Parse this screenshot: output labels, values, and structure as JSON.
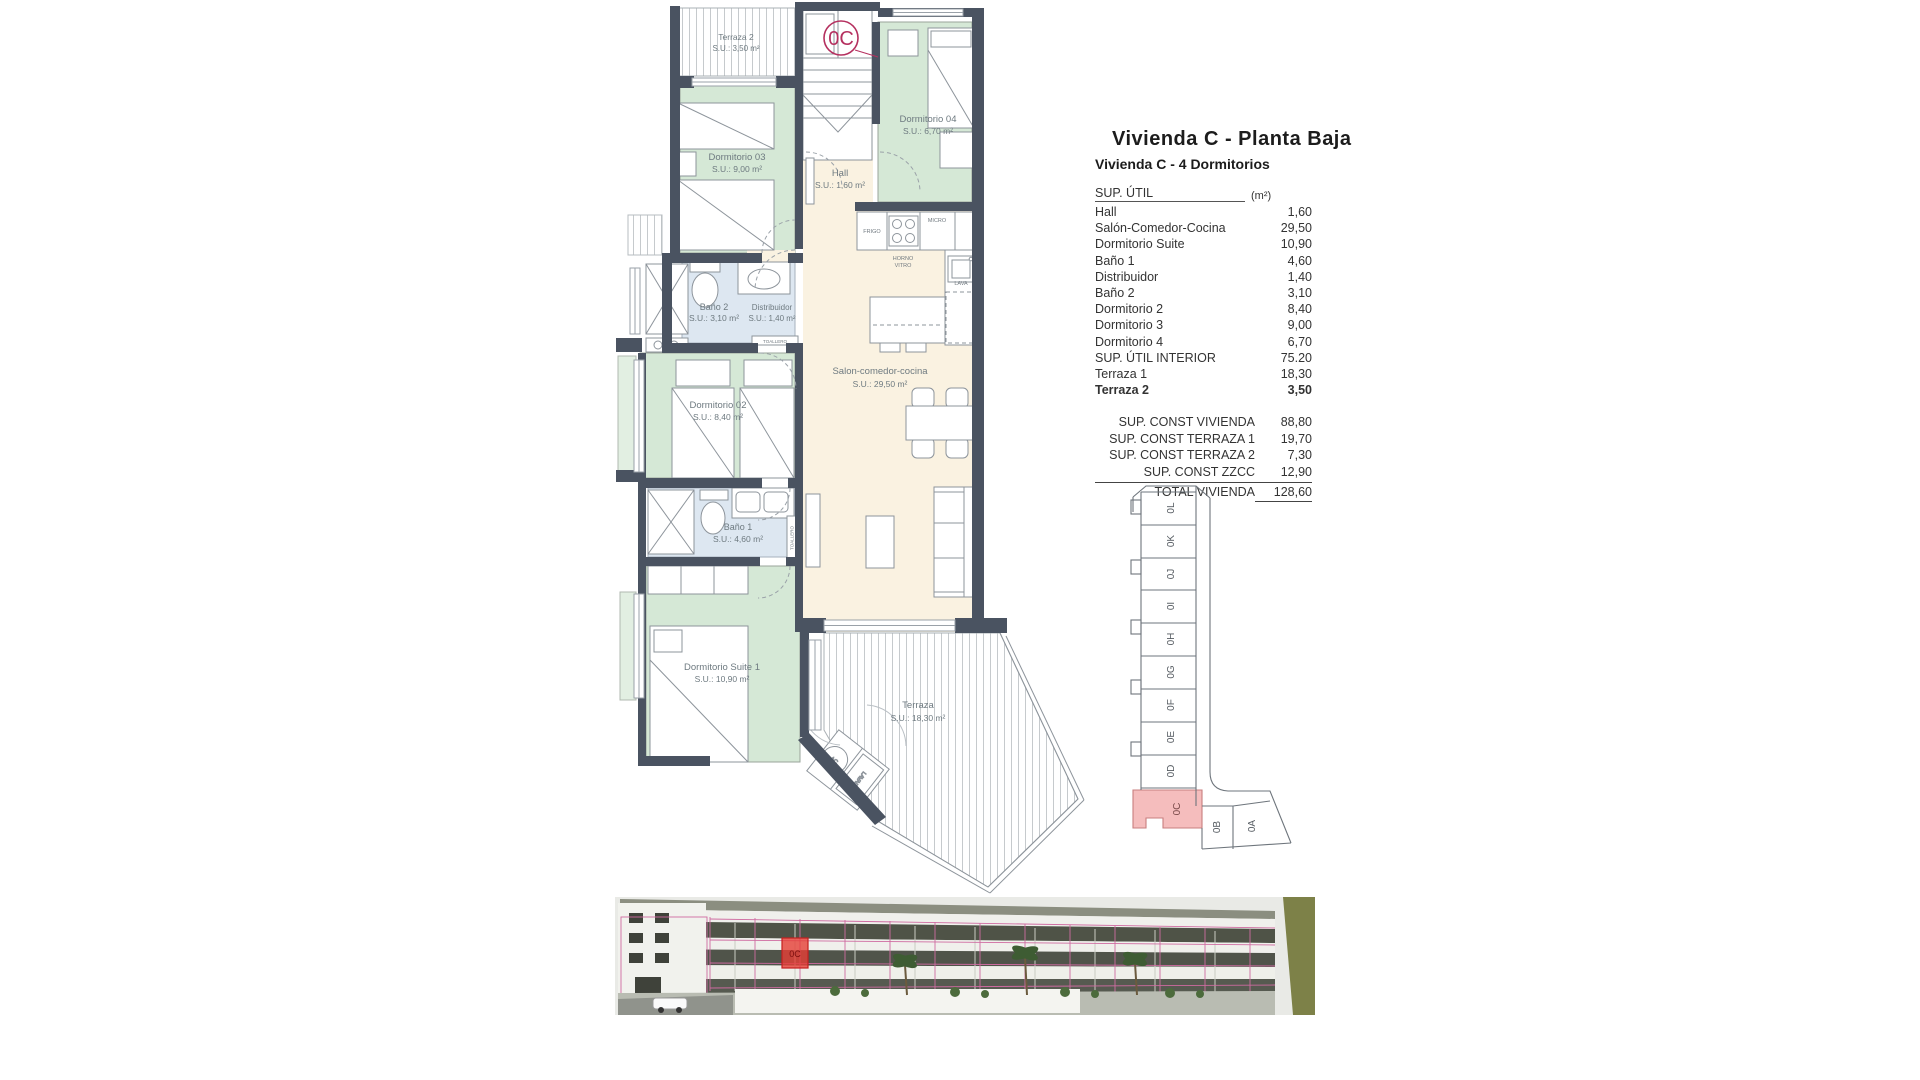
{
  "panel": {
    "title": "Vivienda C - Planta Baja",
    "subtitle": "Vivienda C - 4 Dormitorios",
    "header": {
      "label": "SUP. ÚTIL",
      "unit": "(m²)"
    },
    "rows": [
      {
        "label": "Hall",
        "value": "1,60"
      },
      {
        "label": "Salón-Comedor-Cocina",
        "value": "29,50"
      },
      {
        "label": "Dormitorio Suite",
        "value": "10,90"
      },
      {
        "label": "Baño 1",
        "value": "4,60"
      },
      {
        "label": "Distribuidor",
        "value": "1,40"
      },
      {
        "label": "Baño 2",
        "value": "3,10"
      },
      {
        "label": "Dormitorio 2",
        "value": "8,40"
      },
      {
        "label": "Dormitorio 3",
        "value": "9,00"
      },
      {
        "label": "Dormitorio 4",
        "value": "6,70"
      },
      {
        "label": "SUP. ÚTIL INTERIOR",
        "value": "75.20"
      },
      {
        "label": "Terraza 1",
        "value": "18,30"
      },
      {
        "label": "Terraza 2",
        "value": "3,50"
      }
    ],
    "summary": [
      {
        "label": "SUP. CONST VIVIENDA",
        "value": "88,80"
      },
      {
        "label": "SUP. CONST TERRAZA 1",
        "value": "19,70"
      },
      {
        "label": "SUP. CONST TERRAZA 2",
        "value": "7,30"
      },
      {
        "label": "SUP. CONST ZZCC",
        "value": "12,90"
      }
    ],
    "total": {
      "label": "TOTAL VIVIENDA",
      "value": "128,60"
    }
  },
  "plan": {
    "badge": "0C",
    "rooms": [
      {
        "name": "Terraza 2",
        "area": "S.U.: 3,50 m²"
      },
      {
        "name": "Dormitorio 03",
        "area": "S.U.: 9,00 m²"
      },
      {
        "name": "Dormitorio 04",
        "area": "S.U.: 6,70 m²"
      },
      {
        "name": "Hall",
        "area": "S.U.: 1,60 m²"
      },
      {
        "name": "Baño 2",
        "area": "S.U.: 3,10 m²"
      },
      {
        "name": "Distribuidor",
        "area": "S.U.: 1,40 m²"
      },
      {
        "name": "Dormitorio 02",
        "area": "S.U.: 8,40 m²"
      },
      {
        "name": "Salon-comedor-cocina",
        "area": "S.U.: 29,50 m²"
      },
      {
        "name": "Baño 1",
        "area": "S.U.: 4,60 m²"
      },
      {
        "name": "Dormitorio Suite 1",
        "area": "S.U.: 10,90 m²"
      },
      {
        "name": "Terraza",
        "area": "S.U.: 18,30 m²"
      }
    ],
    "fixtures": {
      "frigo": "FRIGO",
      "micro": "MICRO",
      "horno1": "HORNO",
      "horno2": "VITRO",
      "lava": "LAVA",
      "toallero1": "TOALLERO",
      "toallero2": "TOALLERO",
      "ac": "AC",
      "lavad": "LAVAD"
    }
  },
  "key_plan": {
    "highlighted": "0C",
    "units": [
      "0L",
      "0K",
      "0J",
      "0I",
      "0H",
      "0G",
      "0F",
      "0E",
      "0D",
      "0C",
      "0B",
      "0A"
    ]
  },
  "photo": {
    "highlight": "0C"
  },
  "colors": {
    "wall": "#4a5361",
    "bedroom_fill": "#d5e8d6",
    "living_fill": "#faf2e1",
    "bath_fill": "#dde7f1",
    "badge": "#b5305f",
    "keyplan_highlight": "#f5bdbd",
    "photo_overlay_pink": "#cf6ba1",
    "photo_overlay_red": "#e63e36"
  }
}
